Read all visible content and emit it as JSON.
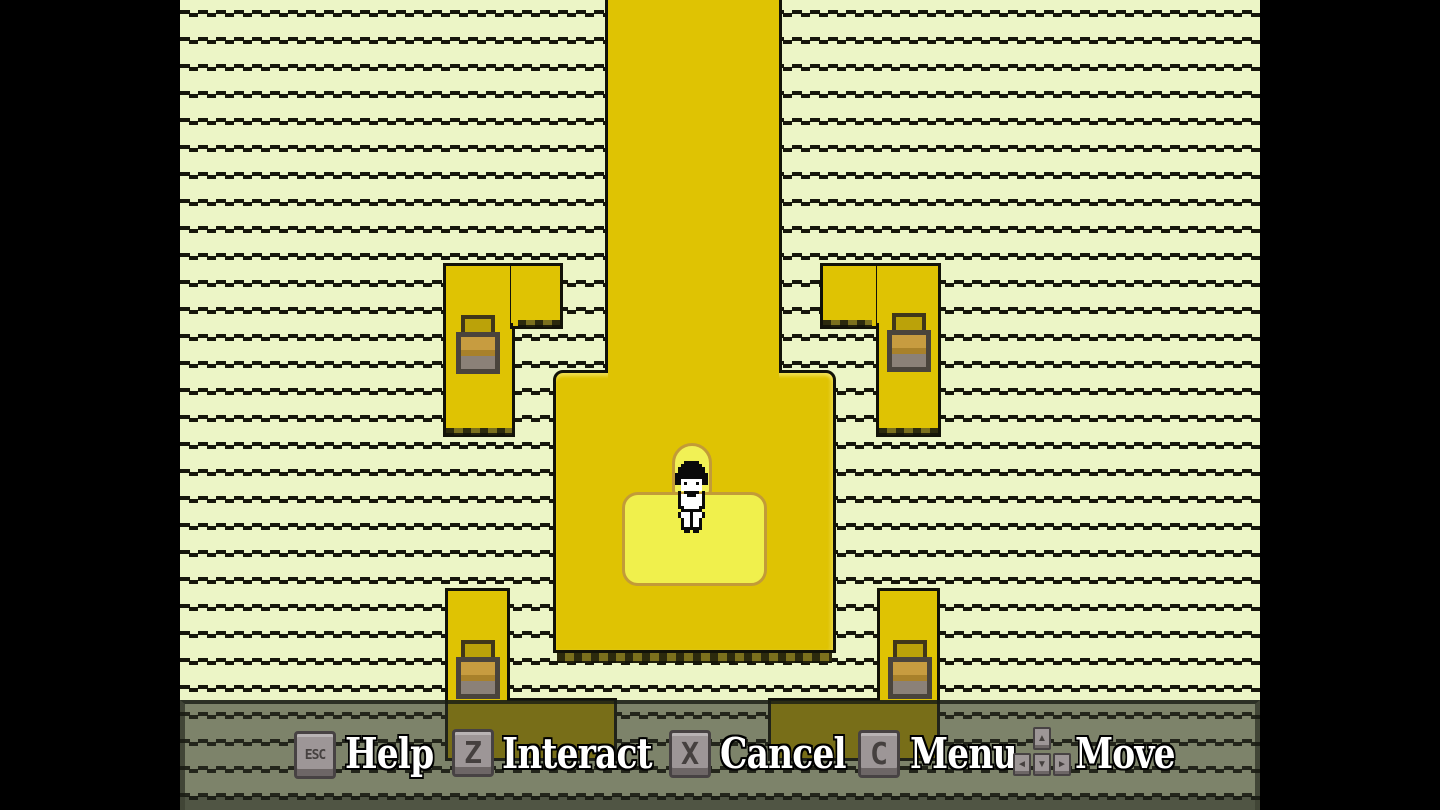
{
  "hud": {
    "items": [
      {
        "key": "ESC",
        "label": "Help"
      },
      {
        "key": "Z",
        "label": "Interact"
      },
      {
        "key": "X",
        "label": "Cancel"
      },
      {
        "key": "C",
        "label": "Menu"
      },
      {
        "key": "ARROWS",
        "label": "Move",
        "arrows": {
          "up": "▲",
          "left": "◄",
          "down": "▼",
          "right": "►"
        }
      }
    ]
  },
  "colors": {
    "background": "#ECF5C6",
    "stripe": "#16160B",
    "platform_gold": "#DFC303",
    "platform_outline": "#121208",
    "ledge_olive": "#7B701D",
    "blanket_yellow": "#F0F04C",
    "bedroll_yellow": "#F1F155",
    "blanket_border": "#C29B38",
    "basket_frame": "#4A443C",
    "basket_amber_light": "#C79C40",
    "basket_amber_dark": "#A8812B",
    "basket_gray": "#8B8178",
    "hud_overlay": "rgba(45,48,40,0.58)",
    "key_cap": "#9D9697",
    "key_border": "#474243",
    "key_glyph": "#45403F",
    "label_text": "#FFFFFF"
  }
}
